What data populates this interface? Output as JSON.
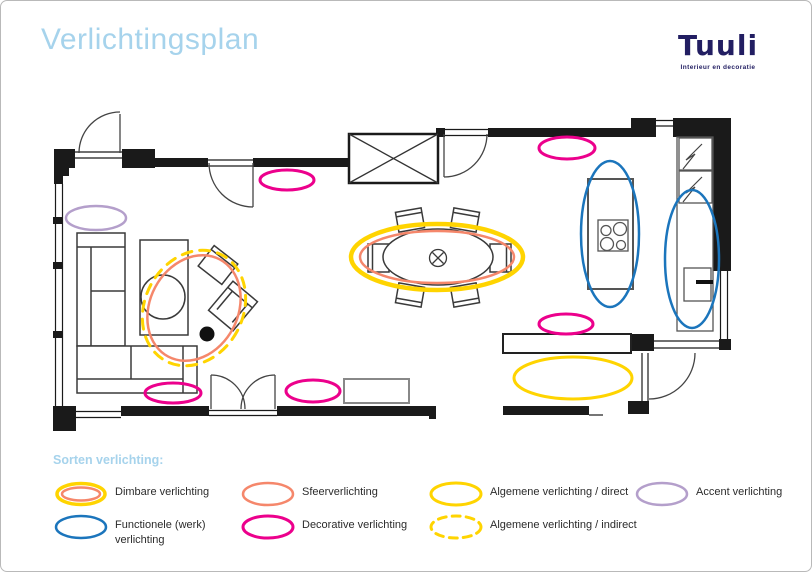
{
  "page": {
    "title": "Verlichtingsplan"
  },
  "logo": {
    "name": "Tuuli",
    "tagline": "Interieur en decoratie"
  },
  "legend": {
    "heading": "Sorten verlichting:",
    "items": [
      {
        "type": "dimbare",
        "label": "Dimbare verlichting",
        "col": 0,
        "row": 0
      },
      {
        "type": "sfeer",
        "label": "Sfeerverlichting",
        "col": 1,
        "row": 0
      },
      {
        "type": "direct",
        "label": "Algemene verlichting / direct",
        "col": 2,
        "row": 0
      },
      {
        "type": "accent",
        "label": "Accent verlichting",
        "col": 3,
        "row": 0
      },
      {
        "type": "functioneel",
        "label": "Functionele (werk) verlichting",
        "col": 0,
        "row": 1,
        "wrap": true
      },
      {
        "type": "decoratief",
        "label": "Decorative verlichting",
        "col": 1,
        "row": 1
      },
      {
        "type": "indirect",
        "label": "Algemene verlichting / indirect",
        "col": 2,
        "row": 1
      }
    ]
  },
  "colors": {
    "decoratief": "#ec008c",
    "sfeer": "#f5876b",
    "dimbare_outer": "#ffd400",
    "dimbare_inner": "#f5876b",
    "direct": "#ffd400",
    "indirect": "#ffd400",
    "functioneel": "#1b75bc",
    "accent": "#b49fcb",
    "walls": "#1a1a1a"
  },
  "plan": {
    "lights": [
      {
        "type": "accent",
        "cx": 95,
        "cy": 217,
        "rx": 30,
        "ry": 12
      },
      {
        "type": "decoratief",
        "cx": 286,
        "cy": 179,
        "rx": 27,
        "ry": 10
      },
      {
        "type": "decoratief",
        "cx": 566,
        "cy": 147,
        "rx": 28,
        "ry": 11
      },
      {
        "type": "decoratief",
        "cx": 565,
        "cy": 323,
        "rx": 27,
        "ry": 10
      },
      {
        "type": "decoratief",
        "cx": 172,
        "cy": 392,
        "rx": 28,
        "ry": 10
      },
      {
        "type": "decoratief",
        "cx": 312,
        "cy": 390,
        "rx": 27,
        "ry": 11
      },
      {
        "type": "indirect",
        "cx": 193,
        "cy": 307,
        "rx": 49,
        "ry": 60,
        "rot": 28
      },
      {
        "type": "sfeer",
        "cx": 193,
        "cy": 307,
        "rx": 44,
        "ry": 55,
        "rot": 28
      },
      {
        "type": "dimbare",
        "cx": 436,
        "cy": 256,
        "rx": 86,
        "ry": 33
      },
      {
        "type": "functioneel",
        "cx": 609,
        "cy": 233,
        "rx": 29,
        "ry": 73
      },
      {
        "type": "functioneel",
        "cx": 691,
        "cy": 258,
        "rx": 27,
        "ry": 69
      },
      {
        "type": "direct",
        "cx": 572,
        "cy": 377,
        "rx": 59,
        "ry": 21
      }
    ]
  }
}
